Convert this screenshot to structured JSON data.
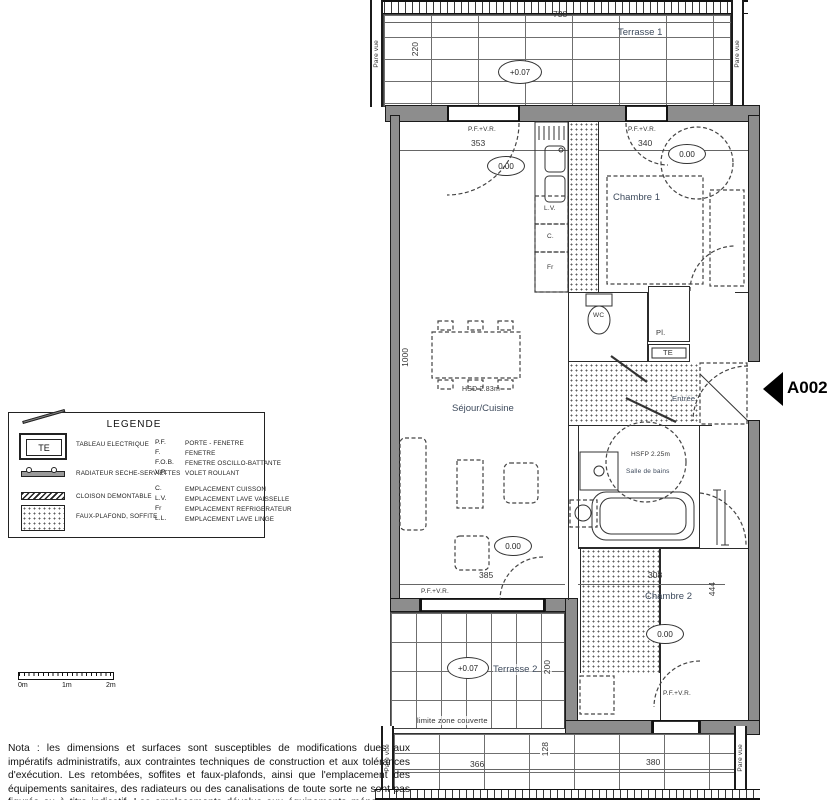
{
  "labels": {
    "pfvr": "P.F.+V.R.",
    "pare_vue": "Pare vue",
    "level_zero": "0.00",
    "level_terrace": "+0.07"
  },
  "unit": {
    "tag": "A002"
  },
  "terrace1": {
    "name": "Terrasse 1",
    "width_dim": "738",
    "depth_dim": "220"
  },
  "sejour": {
    "name": "Séjour/Cuisine",
    "ceiling": "HSD 2.83m",
    "top_dim": "353",
    "bottom_dim": "385",
    "side_dim": "1000"
  },
  "kitchen": {
    "lv": "L.V.",
    "c": "C.",
    "fr": "Fr"
  },
  "chambre1": {
    "name": "Chambre 1",
    "top_dim": "340"
  },
  "wc": {
    "name": "WC"
  },
  "entree": {
    "name": "Entrée",
    "closet": "Pl.",
    "tableau": "TE"
  },
  "bath": {
    "name": "Salle de bains",
    "ceiling": "HSFP 2.25m"
  },
  "chambre2": {
    "name": "Chambre 2",
    "width_dim": "308",
    "height_dim": "444"
  },
  "terrasse2": {
    "name": "Terrasse 2",
    "depth_dim": "200"
  },
  "limit_note": "limite zone couverte",
  "bottom_strip": {
    "dim_left": "366",
    "dim_mid": "128",
    "dim_right": "380"
  },
  "legend": {
    "title": "LEGENDE",
    "symbols": [
      {
        "glyph": "TE",
        "label": "TABLEAU ELECTRIQUE"
      },
      {
        "label": "RADIATEUR SECHE-SERVIETTES"
      },
      {
        "label": "CLOISON DEMONTABLE"
      },
      {
        "label": "FAUX-PLAFOND, SOFFITE"
      }
    ],
    "abbr": [
      {
        "k": "P.F.",
        "v": "PORTE - FENETRE"
      },
      {
        "k": "F.",
        "v": "FENETRE"
      },
      {
        "k": "F.O.B.",
        "v": "FENETRE OSCILLO-BATTANTE"
      },
      {
        "k": "V.R.",
        "v": "VOLET ROULANT"
      },
      {
        "k": "C.",
        "v": "EMPLACEMENT CUISSON"
      },
      {
        "k": "L.V.",
        "v": "EMPLACEMENT LAVE VAISSELLE"
      },
      {
        "k": "Fr",
        "v": "EMPLACEMENT REFRIGERATEUR"
      },
      {
        "k": "L.L.",
        "v": "EMPLACEMENT LAVE LINGE"
      }
    ]
  },
  "scalebar": {
    "l0": "0m",
    "l1": "1m",
    "l2": "2m"
  },
  "nota": "Nota : les dimensions et surfaces sont susceptibles de modifications dues aux impératifs administratifs, aux contraintes techniques de construction et aux tolérances d'exécution. Les retombées, soffites et faux-plafonds, ainsi que l'emplacement des équipements sanitaires, des radiateurs ou des canalisations de toute sorte ne sont pas figurés ou à titre indicatif. Les emplacements dévolus aux équipements ménagers et ceux liés au nettoyage du linge sont représentés sur le plan en correspondance avec les différents raccordements nécessaires en électricité et en eau, aucun de ces éléments n'est fourni. Le mobilier représenté l'est à titre indicatif et n'est pas fourni. Les terrasses, balcons et loggias sont des parties communes à jouissance privative.",
  "colors": {
    "wall": "#8d8d8d",
    "room_label": "#3d4a5c"
  }
}
